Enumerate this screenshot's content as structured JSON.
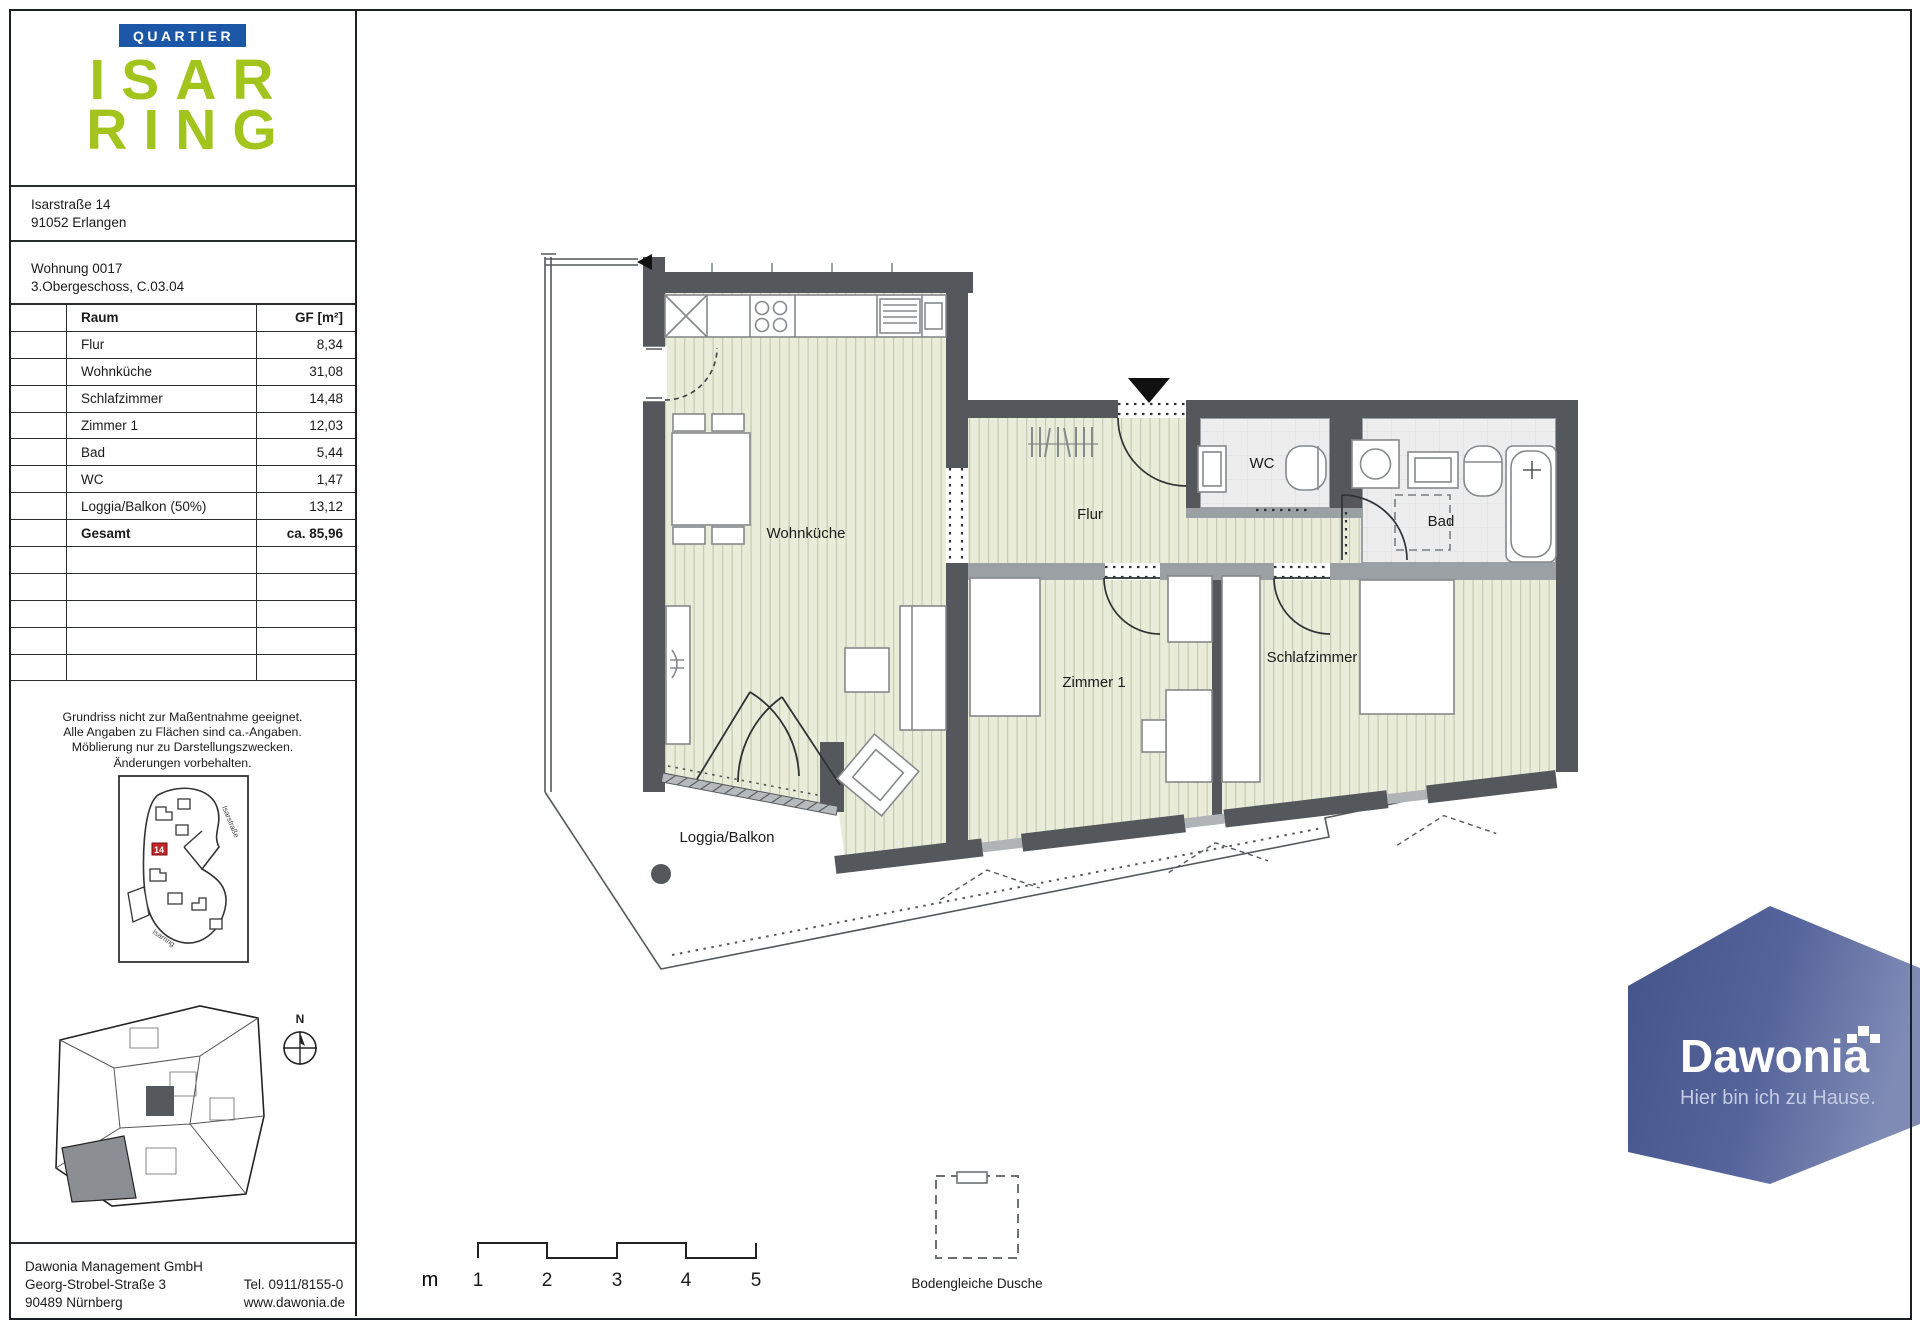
{
  "panel": {
    "badge": "QUARTIER",
    "logo_line1": "ISAR",
    "logo_line2": "RING",
    "address": [
      "Isarstraße 14",
      "91052 Erlangen"
    ],
    "unit": [
      "Wohnung 0017",
      "3.Obergeschoss, C.03.04"
    ],
    "table": {
      "headers": {
        "room": "Raum",
        "area": "GF [m²]"
      },
      "rows": [
        {
          "label": "Flur",
          "value": "8,34"
        },
        {
          "label": "Wohnküche",
          "value": "31,08"
        },
        {
          "label": "Schlafzimmer",
          "value": "14,48"
        },
        {
          "label": "Zimmer 1",
          "value": "12,03"
        },
        {
          "label": "Bad",
          "value": "5,44"
        },
        {
          "label": "WC",
          "value": "1,47"
        },
        {
          "label": "Loggia/Balkon (50%)",
          "value": "13,12"
        }
      ],
      "total": {
        "label": "Gesamt",
        "value": "ca. 85,96"
      }
    },
    "disclaimer": [
      "Grundriss nicht zur Maßentnahme geeignet.",
      "Alle Angaben zu Flächen sind ca.-Angaben.",
      "Möblierung nur zu Darstellungszwecken.",
      "Änderungen vorbehalten."
    ],
    "site_map": {
      "highlight": "14",
      "street_right": "Isarstraße",
      "street_bottom": "Isarring"
    },
    "compass_label": "N",
    "company": {
      "name": "Dawonia Management GmbH",
      "street": "Georg-Strobel-Straße 3",
      "city": "90489 Nürnberg",
      "phone": "Tel. 0911/8155-0",
      "web": "www.dawonia.de"
    }
  },
  "plan": {
    "rooms": {
      "wohnkueche": "Wohnküche",
      "flur": "Flur",
      "wc": "WC",
      "bad": "Bad",
      "zimmer1": "Zimmer 1",
      "schlafzimmer": "Schlafzimmer",
      "loggia": "Loggia/Balkon"
    }
  },
  "scale": {
    "unit": "m",
    "ticks": [
      "1",
      "2",
      "3",
      "4",
      "5"
    ]
  },
  "legend": {
    "shower": "Bodengleiche Dusche"
  },
  "brand": {
    "name": "Dawonia",
    "tagline": "Hier bin ich zu Hause."
  },
  "colors": {
    "logo_green": "#a2c41d",
    "badge_blue": "#1c57a7",
    "brand_blue": "#47568d",
    "wall": "#54585c",
    "partition": "#9ba0a4",
    "floor": "#eaecda",
    "floor_stripe": "#c7cbb3",
    "tile": "#ededee"
  }
}
